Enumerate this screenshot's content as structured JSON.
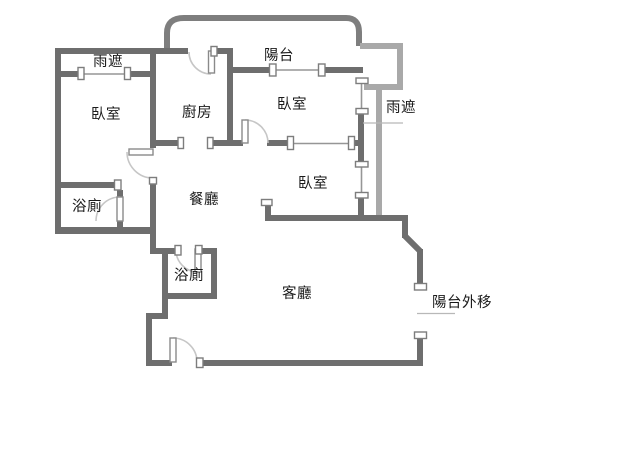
{
  "rooms": {
    "canopy_left": "雨遮",
    "bedroom_left": "臥室",
    "kitchen": "廚房",
    "balcony": "陽台",
    "bedroom_top": "臥室",
    "canopy_right": "雨遮",
    "bedroom_mid": "臥室",
    "bath_upper": "浴廁",
    "dining": "餐廳",
    "bath_lower": "浴廁",
    "living": "客廳",
    "balcony_extension": "陽台外移"
  },
  "colors": {
    "background": "#ffffff",
    "wall_dark": "#6e6e6e",
    "wall_outer": "#7e7e7e",
    "wall_canopy": "#a9a9a9",
    "window_line": "#969696",
    "door_arc": "#c6c6c6",
    "door_leaf": "#8a8a8a",
    "cap_border": "#7d7d7d",
    "leader_line": "#b8b8b8",
    "text_color": "#1a1a1a"
  }
}
